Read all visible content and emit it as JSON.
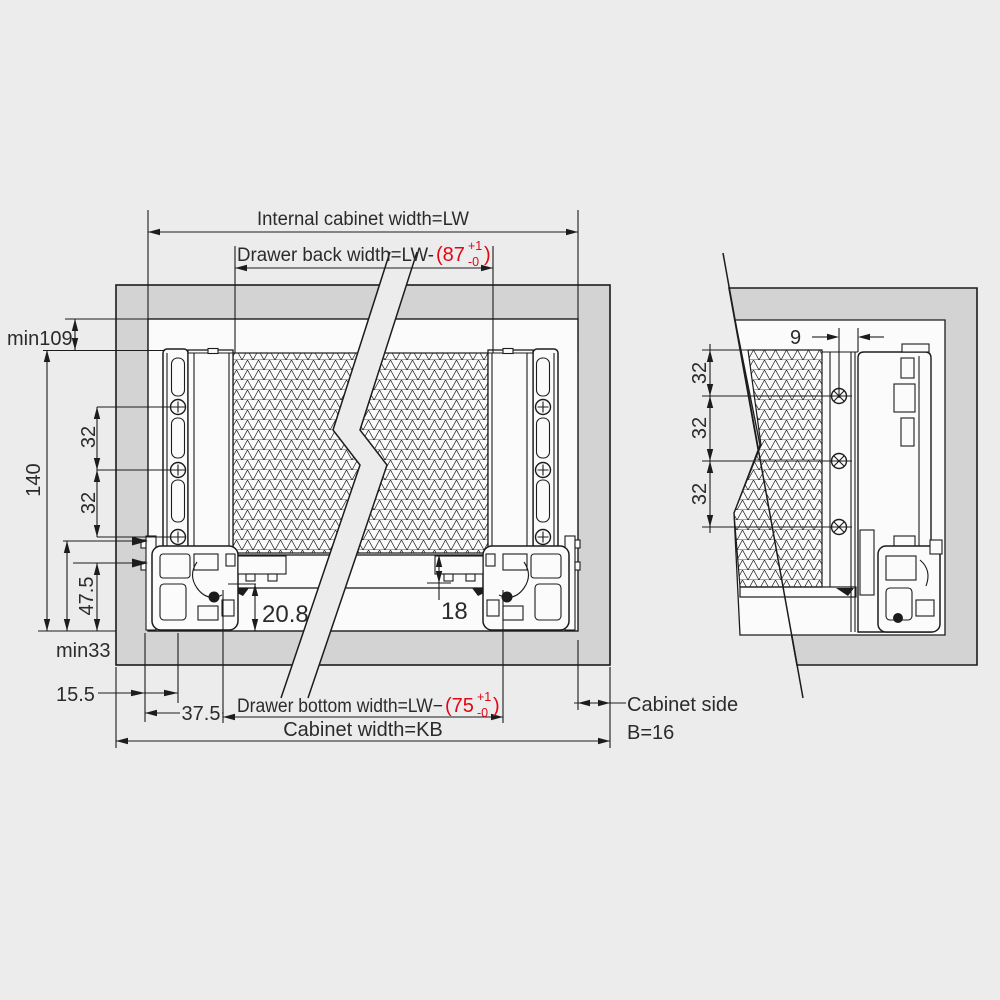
{
  "main_view": {
    "labels": {
      "internal_width": "Internal cabinet width=LW",
      "back_width_prefix": "Drawer back width=LW-",
      "back_width_value": "(87",
      "back_width_tol_sup": "+1",
      "back_width_tol_sub": "-0",
      "back_width_close": ")",
      "bottom_width_prefix": "Drawer bottom width=LW−",
      "bottom_width_value": "(75",
      "bottom_width_tol_sup": "+1",
      "bottom_width_tol_sub": "-0",
      "bottom_width_close": ")",
      "cabinet_width": "Cabinet width=KB"
    },
    "dims": {
      "min_top": "min109",
      "total_height": "140",
      "pitch_a": "32",
      "pitch_b": "32",
      "front_height": "47.5",
      "min_bottom": "min33",
      "front_offset": "15.5",
      "side_offset": "37.5",
      "bottom_recess": "20.8",
      "bottom_thickness": "18"
    }
  },
  "detail_view": {
    "labels": {
      "cabinet_side_line1": "Cabinet side",
      "cabinet_side_line2": "B=16"
    },
    "dims": {
      "back_offset": "9",
      "pitch_1": "32",
      "pitch_2": "32",
      "pitch_3": "32"
    }
  },
  "colors": {
    "background": "#ececec",
    "cabinet_gray": "#d3d3d3",
    "panel_white": "#fbfbfb",
    "line": "#1c1c1c",
    "accent_red": "#e30613"
  }
}
